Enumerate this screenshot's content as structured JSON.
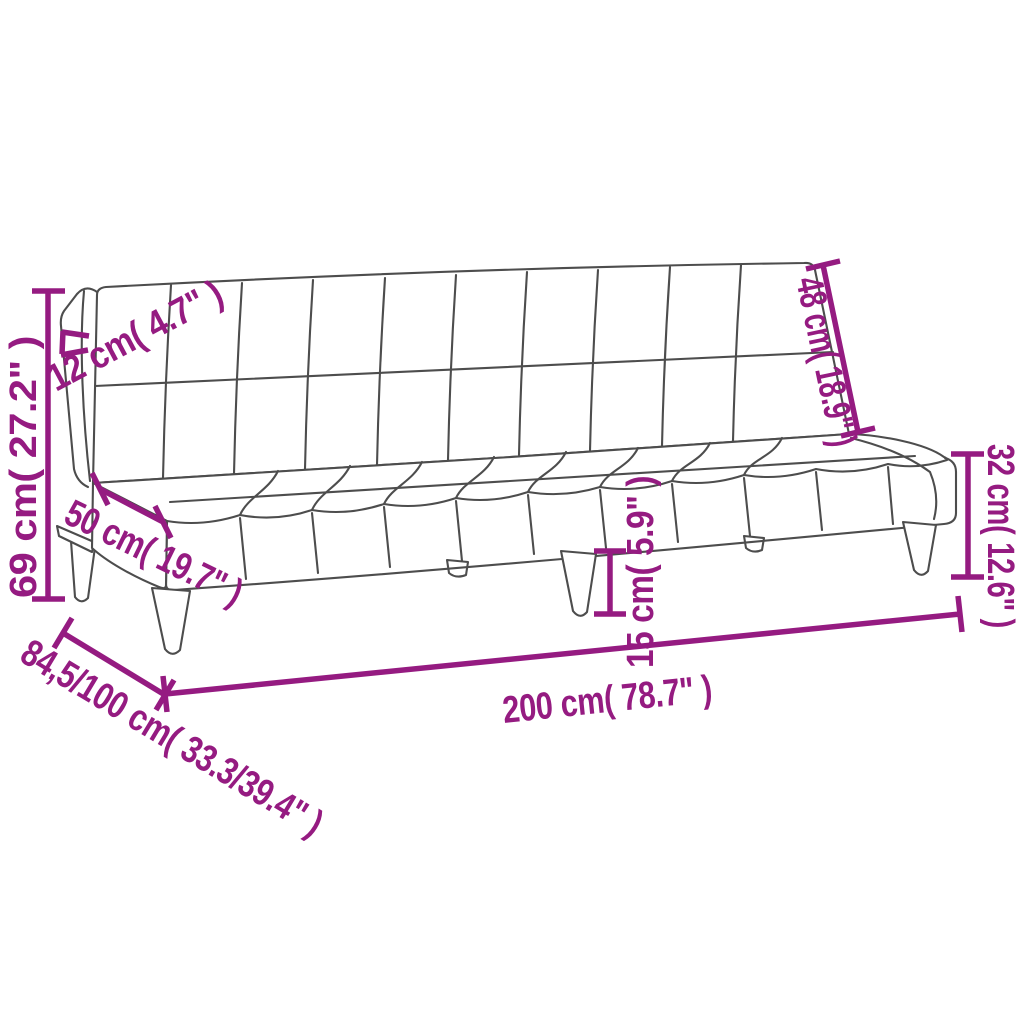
{
  "diagram": {
    "type": "product-dimension-diagram",
    "subject": "armless sofa bed (tufted futon) line drawing",
    "colors": {
      "dimension": "#951b81",
      "outline": "#4d4d4d",
      "background": "#ffffff"
    },
    "labels": {
      "overall_height": "69 cm( 27.2\" )",
      "backrest_thickness": "12 cm( 4.7\" )",
      "seat_depth": "50 cm( 19.7\" )",
      "backrest_length": "48 cm( 18.9\" )",
      "seat_height": "32 cm( 12.6\" )",
      "leg_height": "15 cm( 5.9\" )",
      "overall_width": "200 cm( 78.7\" )",
      "overall_depth": "84,5/100 cm( 33.3/39.4\" )"
    }
  }
}
